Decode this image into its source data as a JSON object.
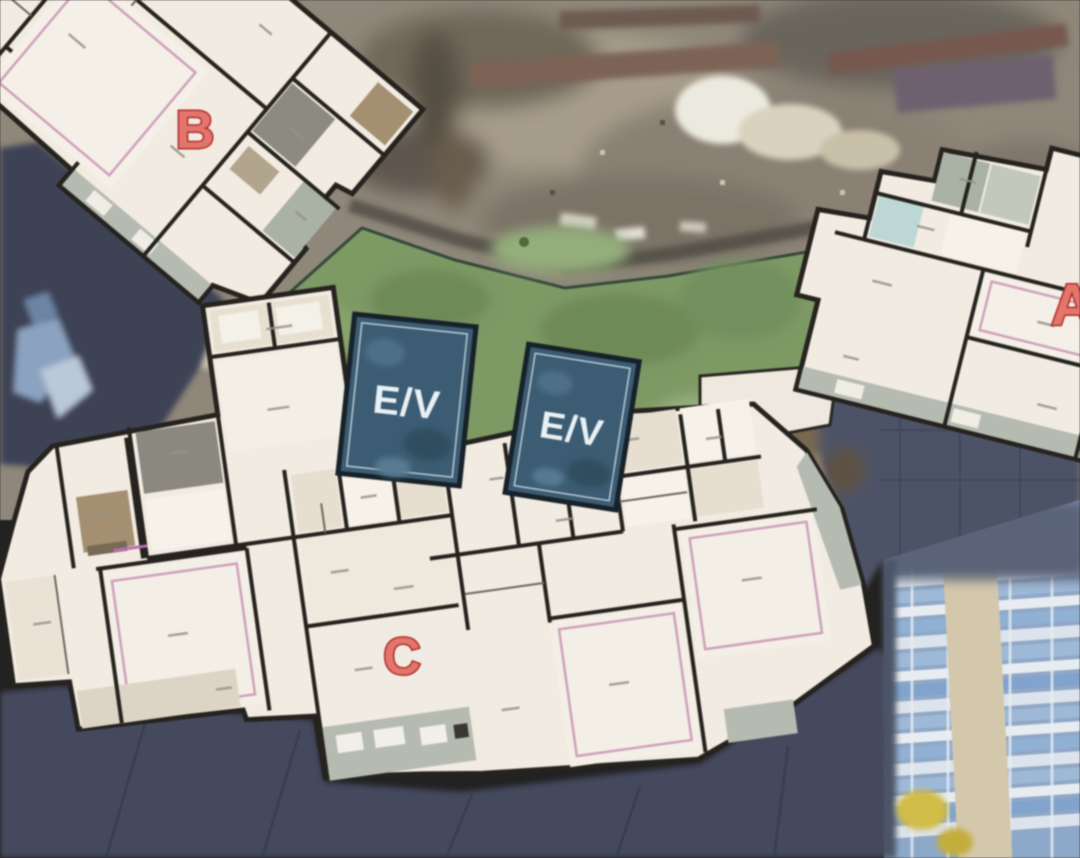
{
  "scene": {
    "type": "construction-aerial-with-floorplan-overlay",
    "building_labels": {
      "b": "B",
      "c": "C",
      "a": "A"
    },
    "elevators": [
      {
        "label": "E/V"
      },
      {
        "label": "E/V"
      }
    ],
    "colors": {
      "label_red": "#e8746b",
      "label_red_outline": "#b32d24",
      "courtyard_green": "#7c9a62",
      "elevator_teal": "#3a5c74",
      "plan_floor": "#f1ebe1",
      "plan_wall": "#26231f",
      "tarp_navy": "#41465b",
      "ground_tan": "#8f8778",
      "facade_blue": "#9db9d9",
      "annotation_pink": "#d0a0bc"
    }
  }
}
